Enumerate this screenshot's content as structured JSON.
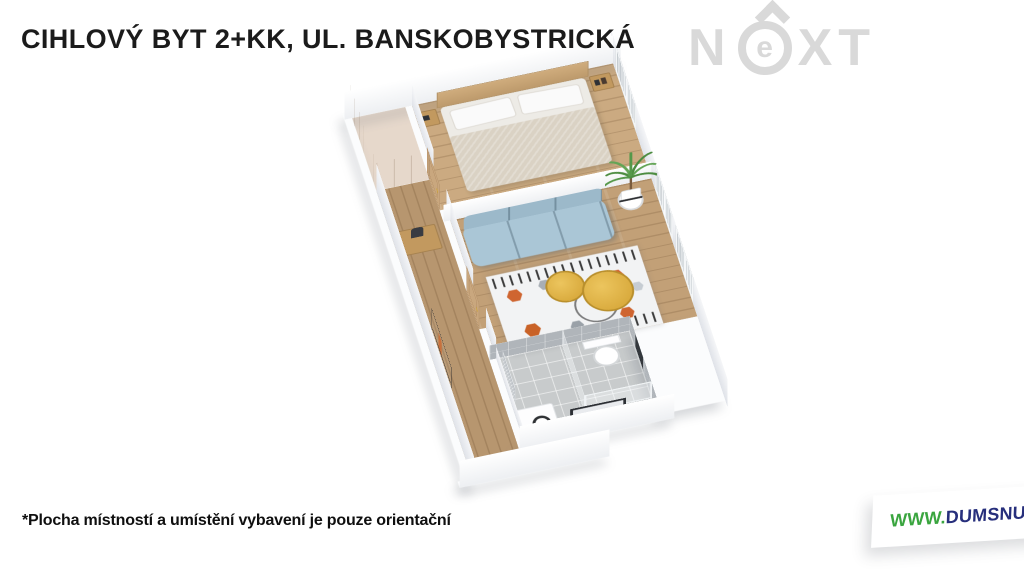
{
  "page": {
    "background": "#ffffff"
  },
  "header": {
    "title": "CIHLOVÝ BYT 2+KK, UL. BANSKOBYSTRICKÁ"
  },
  "watermark": {
    "letter_n": "N",
    "letter_e": "e",
    "letters_xt": "XT",
    "color": "#d9d9d9"
  },
  "footer": {
    "disclaimer": "*Plocha místností a umístění vybavení je pouze orientační",
    "website": {
      "prefix": "WWW.",
      "name": "DUMSNU",
      "suffix": ".COM",
      "green": "#3aa53f",
      "navy": "#272f7c"
    }
  },
  "floorplan": {
    "type": "3d-axonometric-render",
    "rooms": [
      "hallway",
      "bedroom",
      "living-room-with-kitchenette",
      "bathroom"
    ],
    "furniture": [
      "double-bed",
      "headboard-with-nightstands",
      "built-in-wardrobe",
      "console-table",
      "clothes-rack",
      "blue-sofa",
      "patterned-rug",
      "gold-coffee-tables",
      "potted-palm",
      "toilet",
      "towel-radiator",
      "shower-glass",
      "washbasin-cabinet",
      "mirror",
      "wooden-doors",
      "windows"
    ],
    "palette": {
      "wall": "#ffffff",
      "wall_shade": "#e6e8ec",
      "floor_wood": "#c9a87f",
      "floor_tile": "#c8cbcc",
      "sofa_blue": "#a9c2cf",
      "table_gold": "#dcab3c",
      "rug_orange": "#cf6530",
      "door_wood": "#c9a77e",
      "plant_green": "#4c8c40"
    }
  }
}
